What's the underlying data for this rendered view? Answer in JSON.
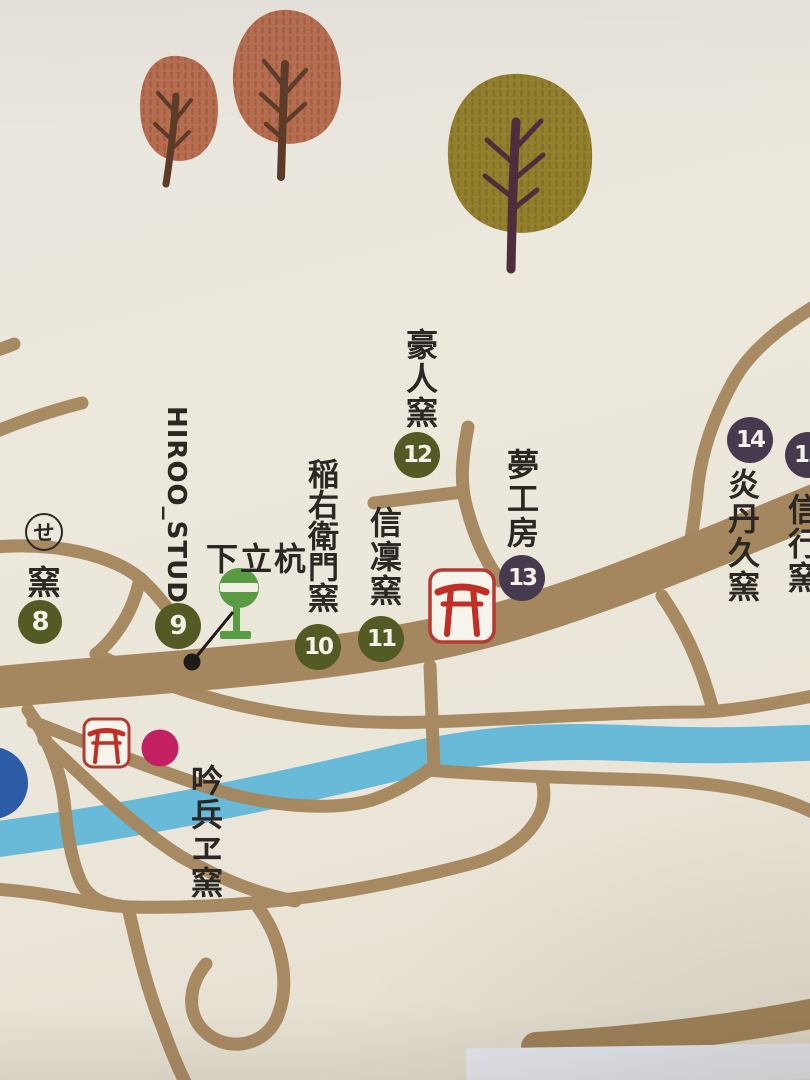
{
  "markers": [
    {
      "number": "8",
      "circled_char": "せ",
      "label": "窯",
      "color": "olive"
    },
    {
      "number": "9",
      "label": "HIROO_STUDIO",
      "color": "olive"
    },
    {
      "number": "10",
      "label": "稲右衛門窯",
      "color": "olive"
    },
    {
      "number": "11",
      "label": "信凜窯",
      "color": "olive"
    },
    {
      "number": "12",
      "label": "豪人窯",
      "color": "olive"
    },
    {
      "number": "13",
      "label": "夢工房",
      "color": "purple"
    },
    {
      "number": "14",
      "label": "炎丹久窯",
      "color": "purple"
    },
    {
      "number": "15",
      "label": "信行窯",
      "color": "purple"
    }
  ],
  "pois": {
    "bus_stop_label": "下立杭",
    "pink_kiln_label": "吟兵ヱ窯"
  },
  "icons": {
    "torii": "torii-shrine-icon",
    "bus_stop": "bus-stop-sign-icon",
    "pink_dot": "kiln-location-dot",
    "pin": "map-pin-dot",
    "clipped_blue_badge": "partial-route-badge"
  },
  "colors": {
    "background": "#ebe7db",
    "road": "#a5875f",
    "river": "#68bad8",
    "olive_badge": "#535a23",
    "purple_badge": "#463a4e",
    "torii_red": "#bf2f26",
    "pink_dot": "#c22060",
    "sign_green": "#589b43",
    "blue_badge": "#2d5ca6",
    "tree_terracotta": "#b76e50",
    "tree_olive": "#93802f"
  }
}
